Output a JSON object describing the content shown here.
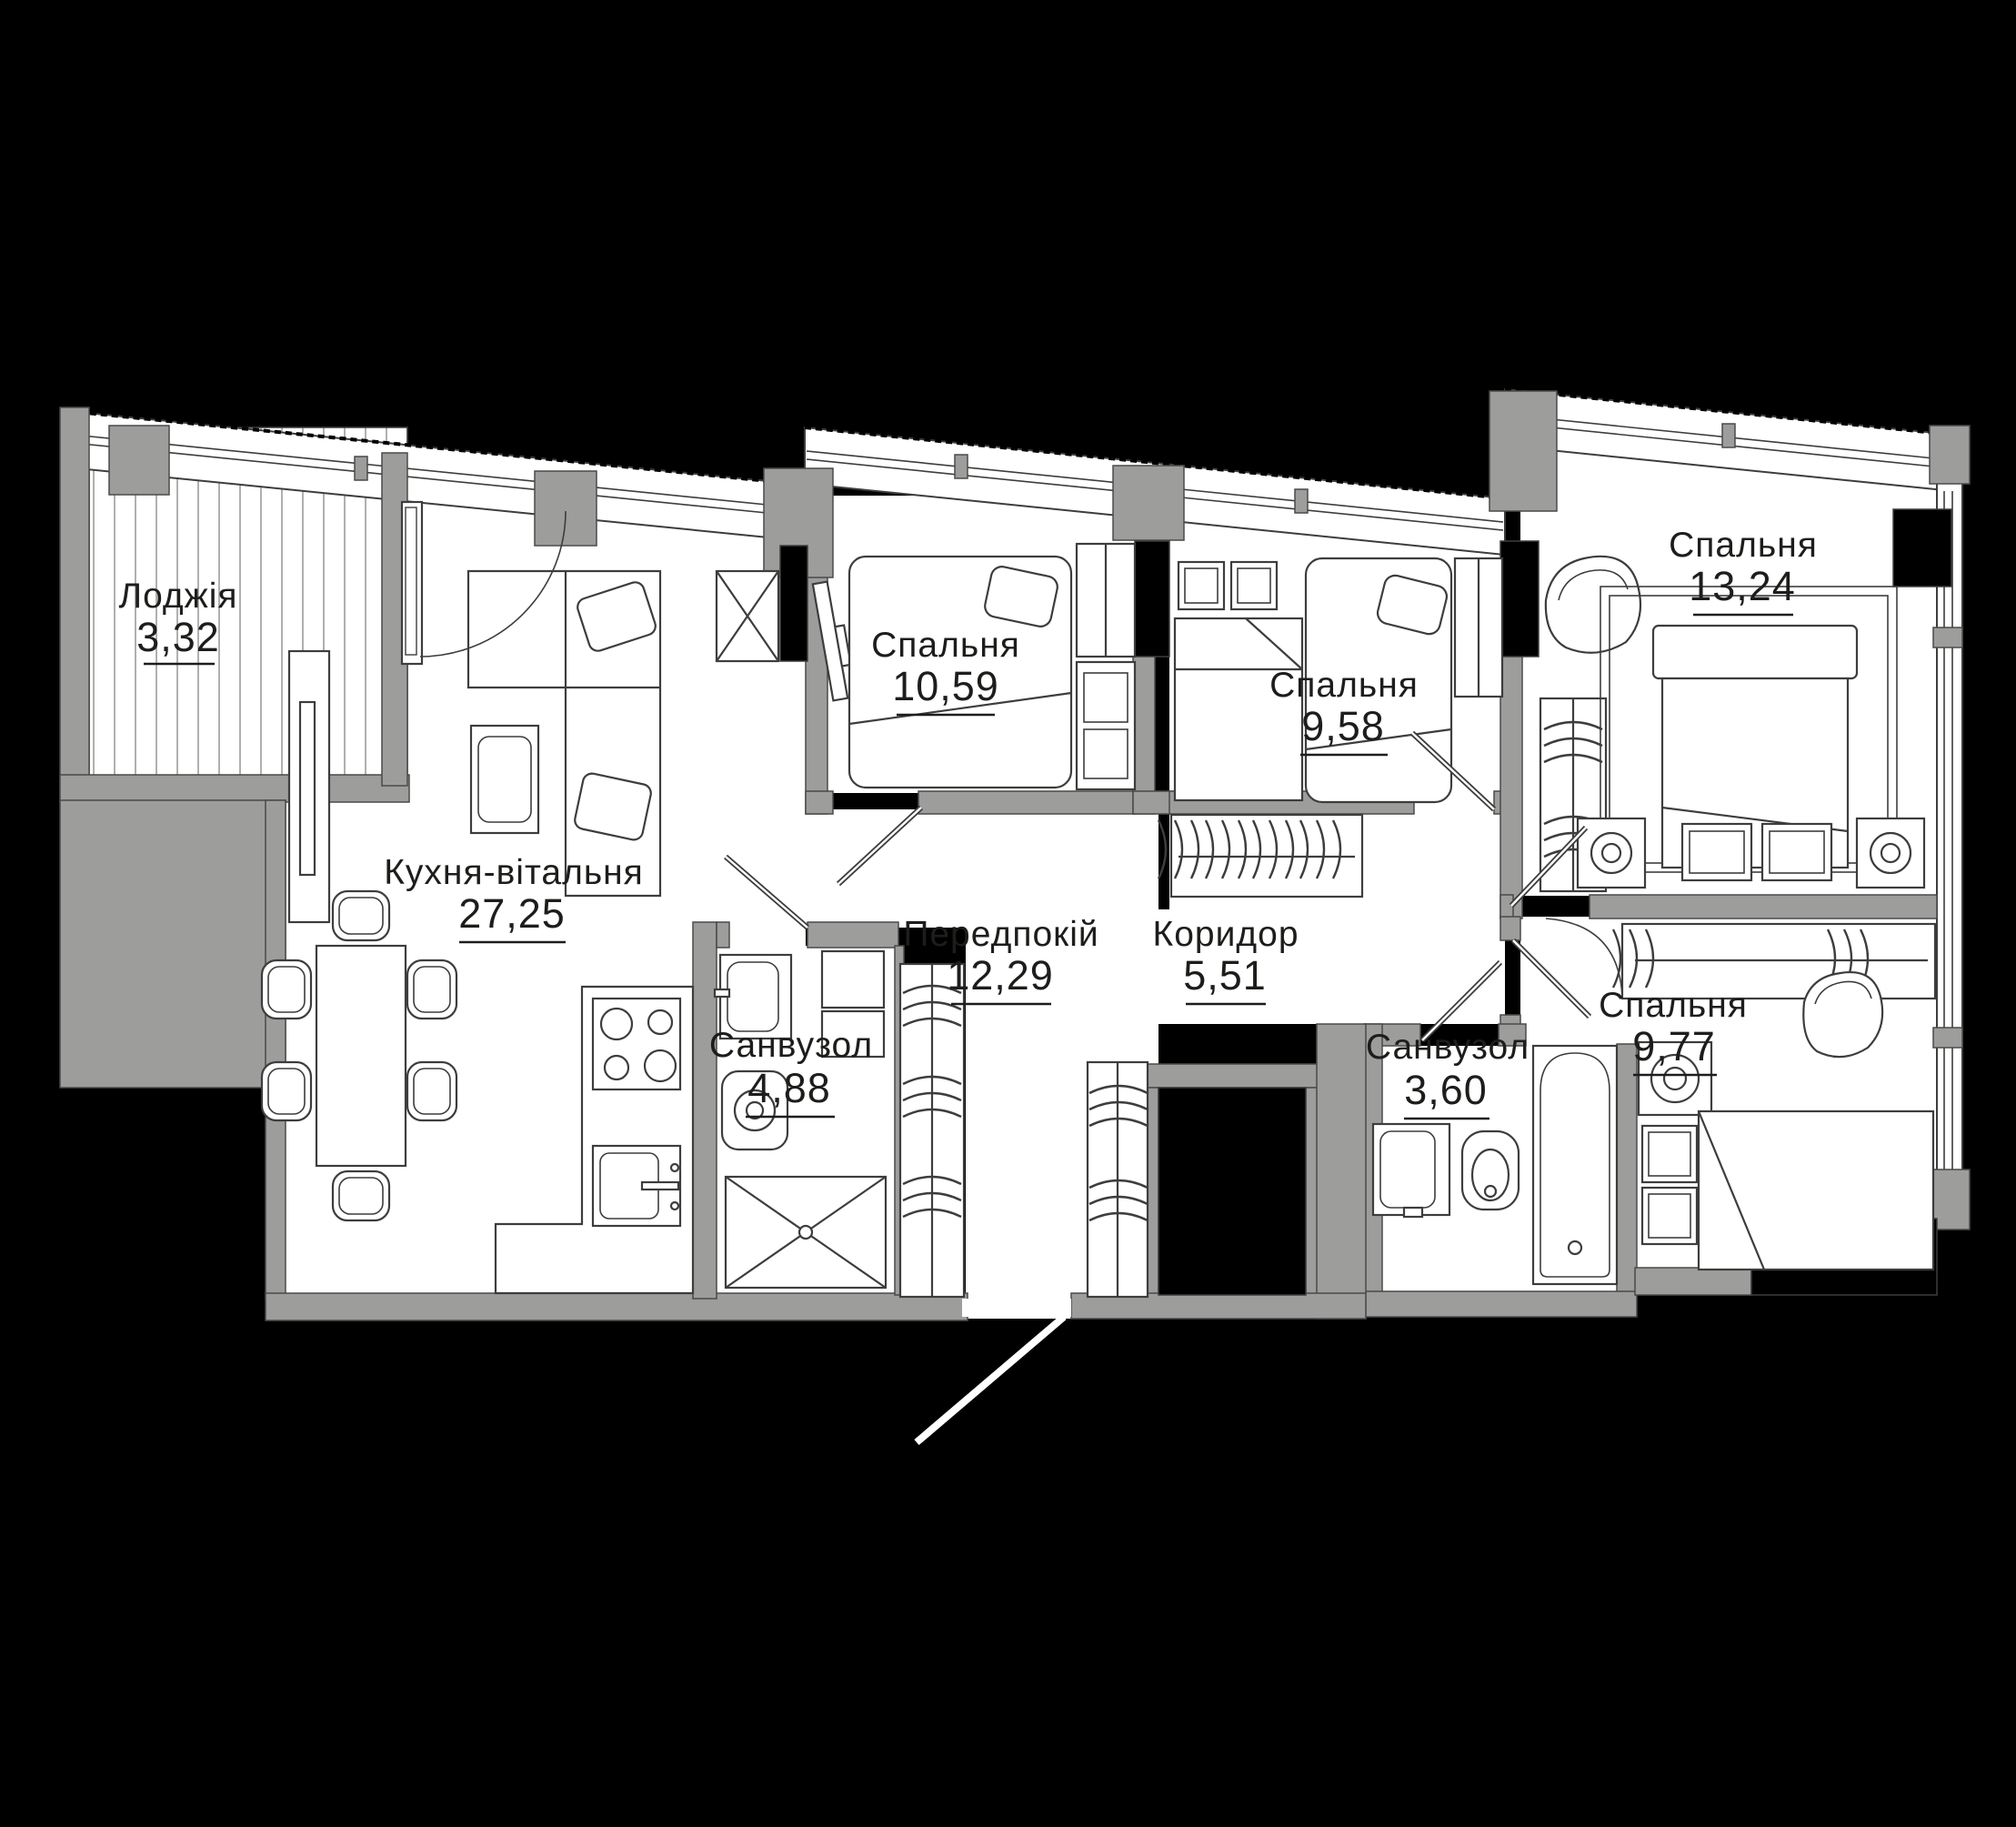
{
  "page": {
    "background": "#000000",
    "kind": "apartment-floor-plan",
    "language": "uk"
  },
  "plan": {
    "rooms": [
      {
        "id": "loggia",
        "label": "Лоджія",
        "area": "3,32"
      },
      {
        "id": "kitchen_living",
        "label": "Кухня-вітальня",
        "area": "27,25"
      },
      {
        "id": "bedroom_1",
        "label": "Спальня",
        "area": "10,59"
      },
      {
        "id": "bedroom_2",
        "label": "Спальня",
        "area": "9,58"
      },
      {
        "id": "bedroom_3",
        "label": "Спальня",
        "area": "13,24"
      },
      {
        "id": "bedroom_4",
        "label": "Спальня",
        "area": "9,77"
      },
      {
        "id": "hallway",
        "label": "Передпокій",
        "area": "12,29"
      },
      {
        "id": "corridor",
        "label": "Коридор",
        "area": "5,51"
      },
      {
        "id": "bathroom_1",
        "label": "Санвузол",
        "area": "4,88"
      },
      {
        "id": "bathroom_2",
        "label": "Санвузол",
        "area": "3,60"
      }
    ],
    "colors": {
      "wall": "#9d9d9c",
      "floor": "#ffffff",
      "line": "#3d3d3d",
      "text": "#1d1d1b",
      "shaft": "#000000",
      "background": "#000000"
    }
  }
}
